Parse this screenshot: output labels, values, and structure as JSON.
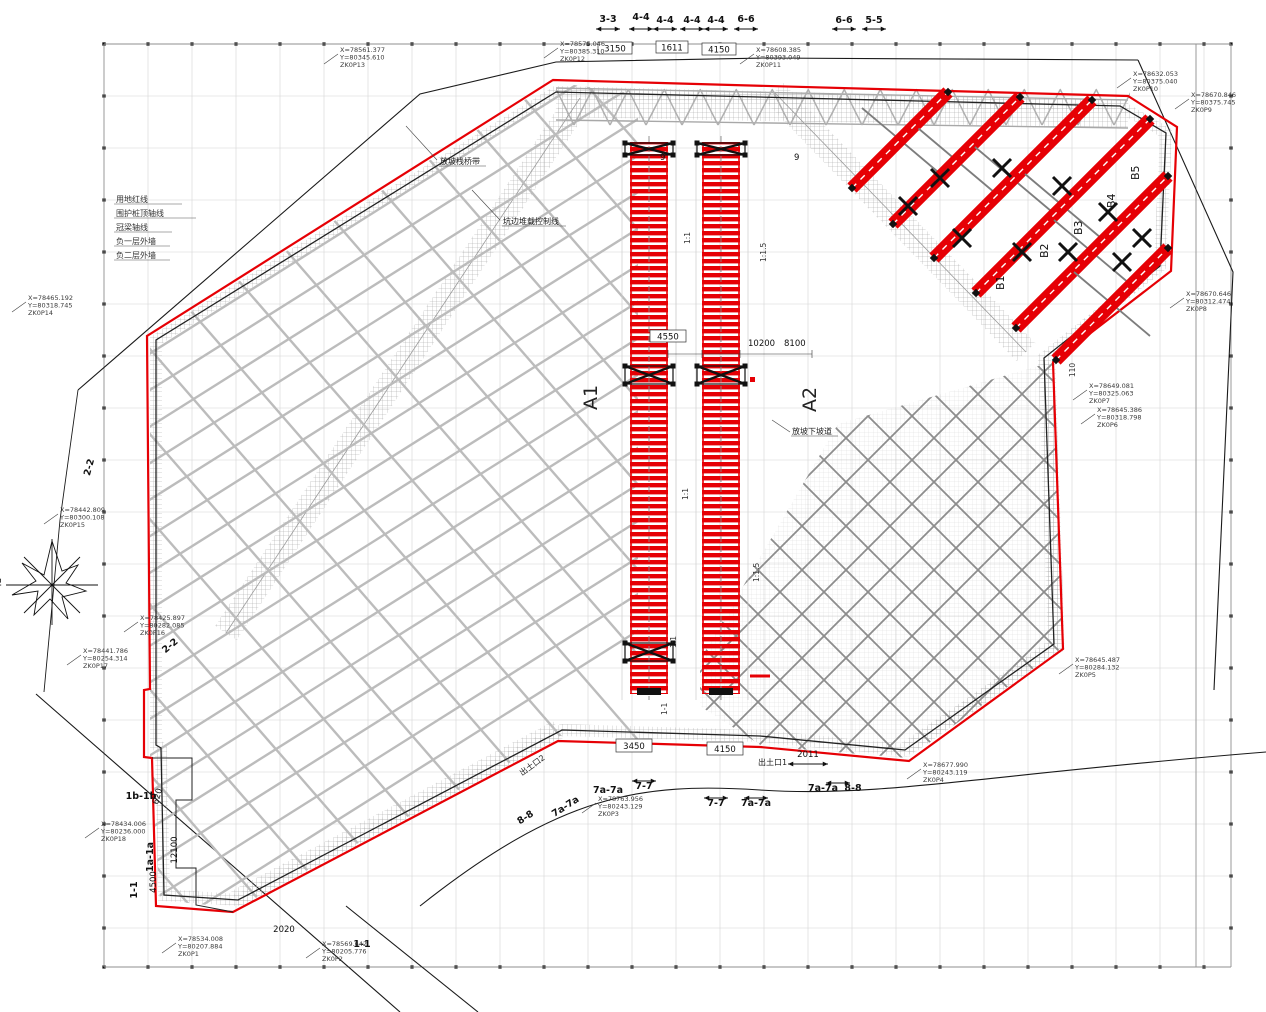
{
  "colors": {
    "accent_red": "#e60005",
    "truss_gray": "#b8b8b8",
    "dark_truss": "#8d8d8d",
    "line_black": "#111111"
  },
  "compass_label": "北",
  "legend_notes": [
    "用地红线",
    "围护桩顶轴线",
    "冠梁轴线",
    "负一层外墙",
    "负二层外墙"
  ],
  "notes": {
    "bridge": "放坡栈桥带",
    "surcharge": "坑边堆载控制线",
    "ramp": "放坡下坡道"
  },
  "top_markers": [
    "3-3",
    "4-4",
    "4-4",
    "4-4",
    "4-4",
    "6-6",
    "6-6",
    "5-5"
  ],
  "top_dims": [
    "3150",
    "1611",
    "4150"
  ],
  "grid_bubbles": [
    "9",
    "9"
  ],
  "area_labels": {
    "a1": "A1",
    "a2": "A2",
    "b1": "B1",
    "b2": "B2",
    "b3": "B3",
    "b4": "B4",
    "b5": "B5"
  },
  "mid_dims": {
    "d1": "4550",
    "d2": "10200",
    "d3": "8100"
  },
  "slopes": {
    "s1": "1:1",
    "s2": "1:1.5",
    "s3": "1:1",
    "s4": "1:1.5",
    "s5": "1:1",
    "s6": "1-1"
  },
  "openings": {
    "o1": "出土口1",
    "o2": "出土口2"
  },
  "bottom_dims": {
    "d1": "3450",
    "d2": "4150",
    "d3": "2011",
    "d4": "2020",
    "d5": "620"
  },
  "left_dims": {
    "d1": "12100",
    "d2": "4500"
  },
  "right_dims": {
    "d1": "110"
  },
  "bottom_markers": {
    "m1": "7a-7a",
    "m2": "7-7",
    "m3": "7-7",
    "m4": "7a-7a",
    "m5": "7a-7a",
    "m6": "8-8",
    "m7": "8-8",
    "m8": "7a-7a",
    "m9": "1-1"
  },
  "left_markers": {
    "m1": "2-2",
    "m2": "2-2",
    "m3": "1b-1b",
    "m4": "1a-1a",
    "m5": "1-1"
  },
  "callouts": [
    {
      "x": "X=78561.377",
      "y": "Y=80345.610",
      "id": "ZK0P13"
    },
    {
      "x": "X=78575.046",
      "y": "Y=80385.310",
      "id": "ZK0P12"
    },
    {
      "x": "X=78608.385",
      "y": "Y=80393.049",
      "id": "ZK0P11"
    },
    {
      "x": "X=78632.053",
      "y": "Y=80375.040",
      "id": "ZK0P10"
    },
    {
      "x": "X=78670.846",
      "y": "Y=80375.745",
      "id": "ZK0P9"
    },
    {
      "x": "X=78670.646",
      "y": "Y=80312.474",
      "id": "ZK0P8"
    },
    {
      "x": "X=78649.081",
      "y": "Y=80325.063",
      "id": "ZK0P7"
    },
    {
      "x": "X=78645.386",
      "y": "Y=80318.798",
      "id": "ZK0P6"
    },
    {
      "x": "X=78645.487",
      "y": "Y=80284.132",
      "id": "ZK0P5"
    },
    {
      "x": "X=78677.990",
      "y": "Y=80243.119",
      "id": "ZK0P4"
    },
    {
      "x": "X=78763.956",
      "y": "Y=80243.129",
      "id": "ZK0P3"
    },
    {
      "x": "X=78569.642",
      "y": "Y=80205.776",
      "id": "ZK0P2"
    },
    {
      "x": "X=78534.008",
      "y": "Y=80207.884",
      "id": "ZK0P1"
    },
    {
      "x": "X=78434.006",
      "y": "Y=80236.000",
      "id": "ZK0P18"
    },
    {
      "x": "X=78441.786",
      "y": "Y=80254.314",
      "id": "ZK0P17"
    },
    {
      "x": "X=78425.897",
      "y": "Y=80282.085",
      "id": "ZK0P16"
    },
    {
      "x": "X=78442.809",
      "y": "Y=80300.108",
      "id": "ZK0P15"
    },
    {
      "x": "X=78465.192",
      "y": "Y=80318.745",
      "id": "ZK0P14"
    }
  ]
}
